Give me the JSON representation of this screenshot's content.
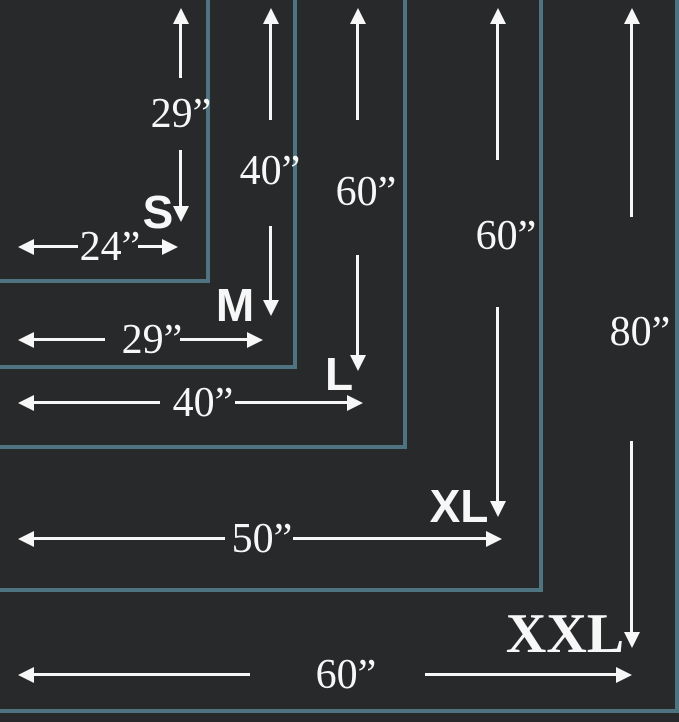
{
  "palette": {
    "background": "#27292b",
    "border": "#4d7480",
    "ink": "#f7f7f7"
  },
  "sizes": [
    {
      "id": "s",
      "label": "S",
      "width": "24”",
      "height": "29”"
    },
    {
      "id": "m",
      "label": "M",
      "width": "29”",
      "height": "40”"
    },
    {
      "id": "l",
      "label": "L",
      "width": "40”",
      "height": "60”"
    },
    {
      "id": "xl",
      "label": "XL",
      "width": "50”",
      "height": "60”"
    },
    {
      "id": "xxl",
      "label": "XXL",
      "width": "60”",
      "height": "80”"
    }
  ]
}
